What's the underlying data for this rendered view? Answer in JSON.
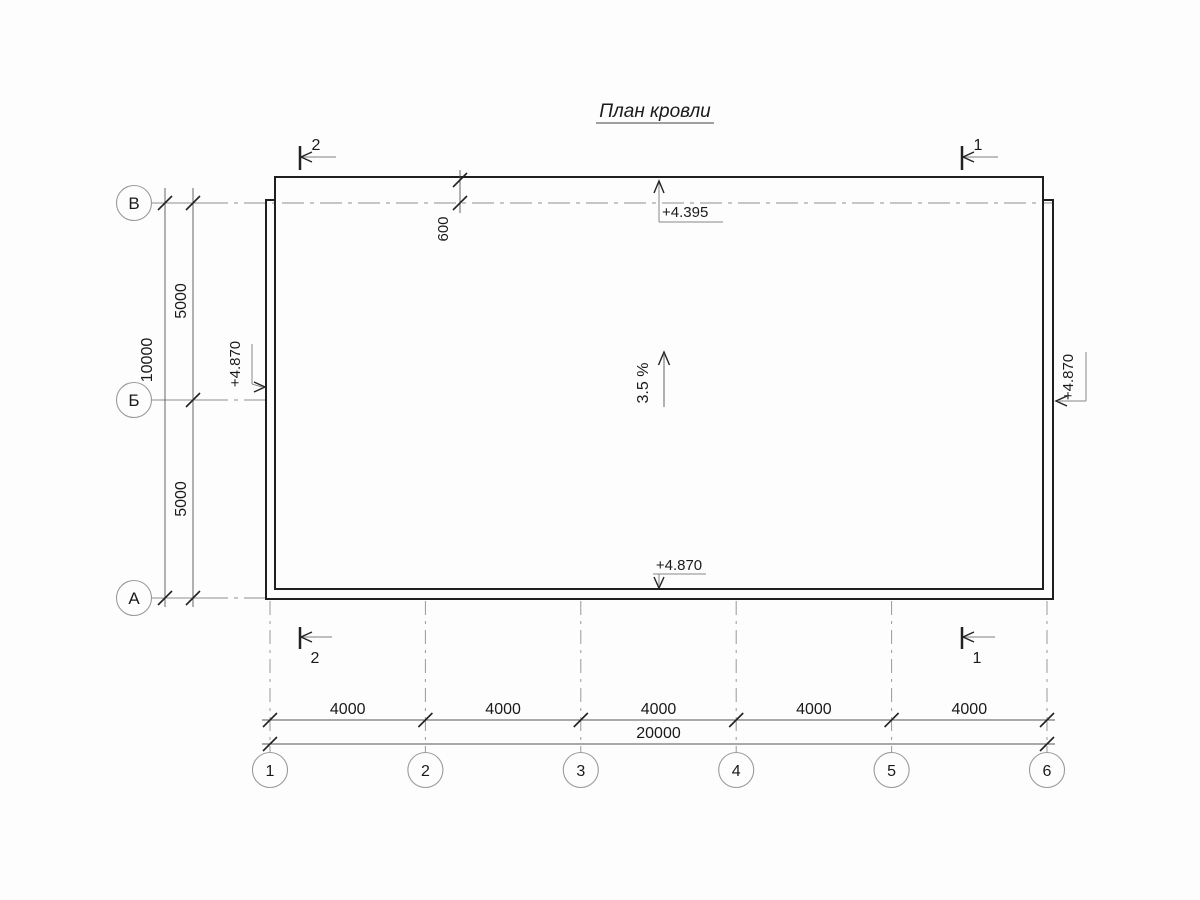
{
  "title": "План кровли",
  "axis_rows": [
    "В",
    "Б",
    "А"
  ],
  "axis_cols": [
    "1",
    "2",
    "3",
    "4",
    "5",
    "6"
  ],
  "dims": {
    "left_segments": [
      "5000",
      "5000"
    ],
    "left_total": "10000",
    "bottom_segments": [
      "4000",
      "4000",
      "4000",
      "4000",
      "4000"
    ],
    "bottom_total": "20000",
    "overhang": "600"
  },
  "elevations": {
    "top": "+4.395",
    "bottom": "+4.870",
    "left": "+4.870",
    "right": "+4.870"
  },
  "slope": "3.5 %",
  "sections": {
    "top_left": "2",
    "top_right": "1",
    "bottom_left": "2",
    "bottom_right": "1"
  },
  "colors": {
    "line": "#1f1f1f",
    "dimension": "#555555",
    "axis": "#8f8f8f",
    "background": "#fdfdfd"
  }
}
